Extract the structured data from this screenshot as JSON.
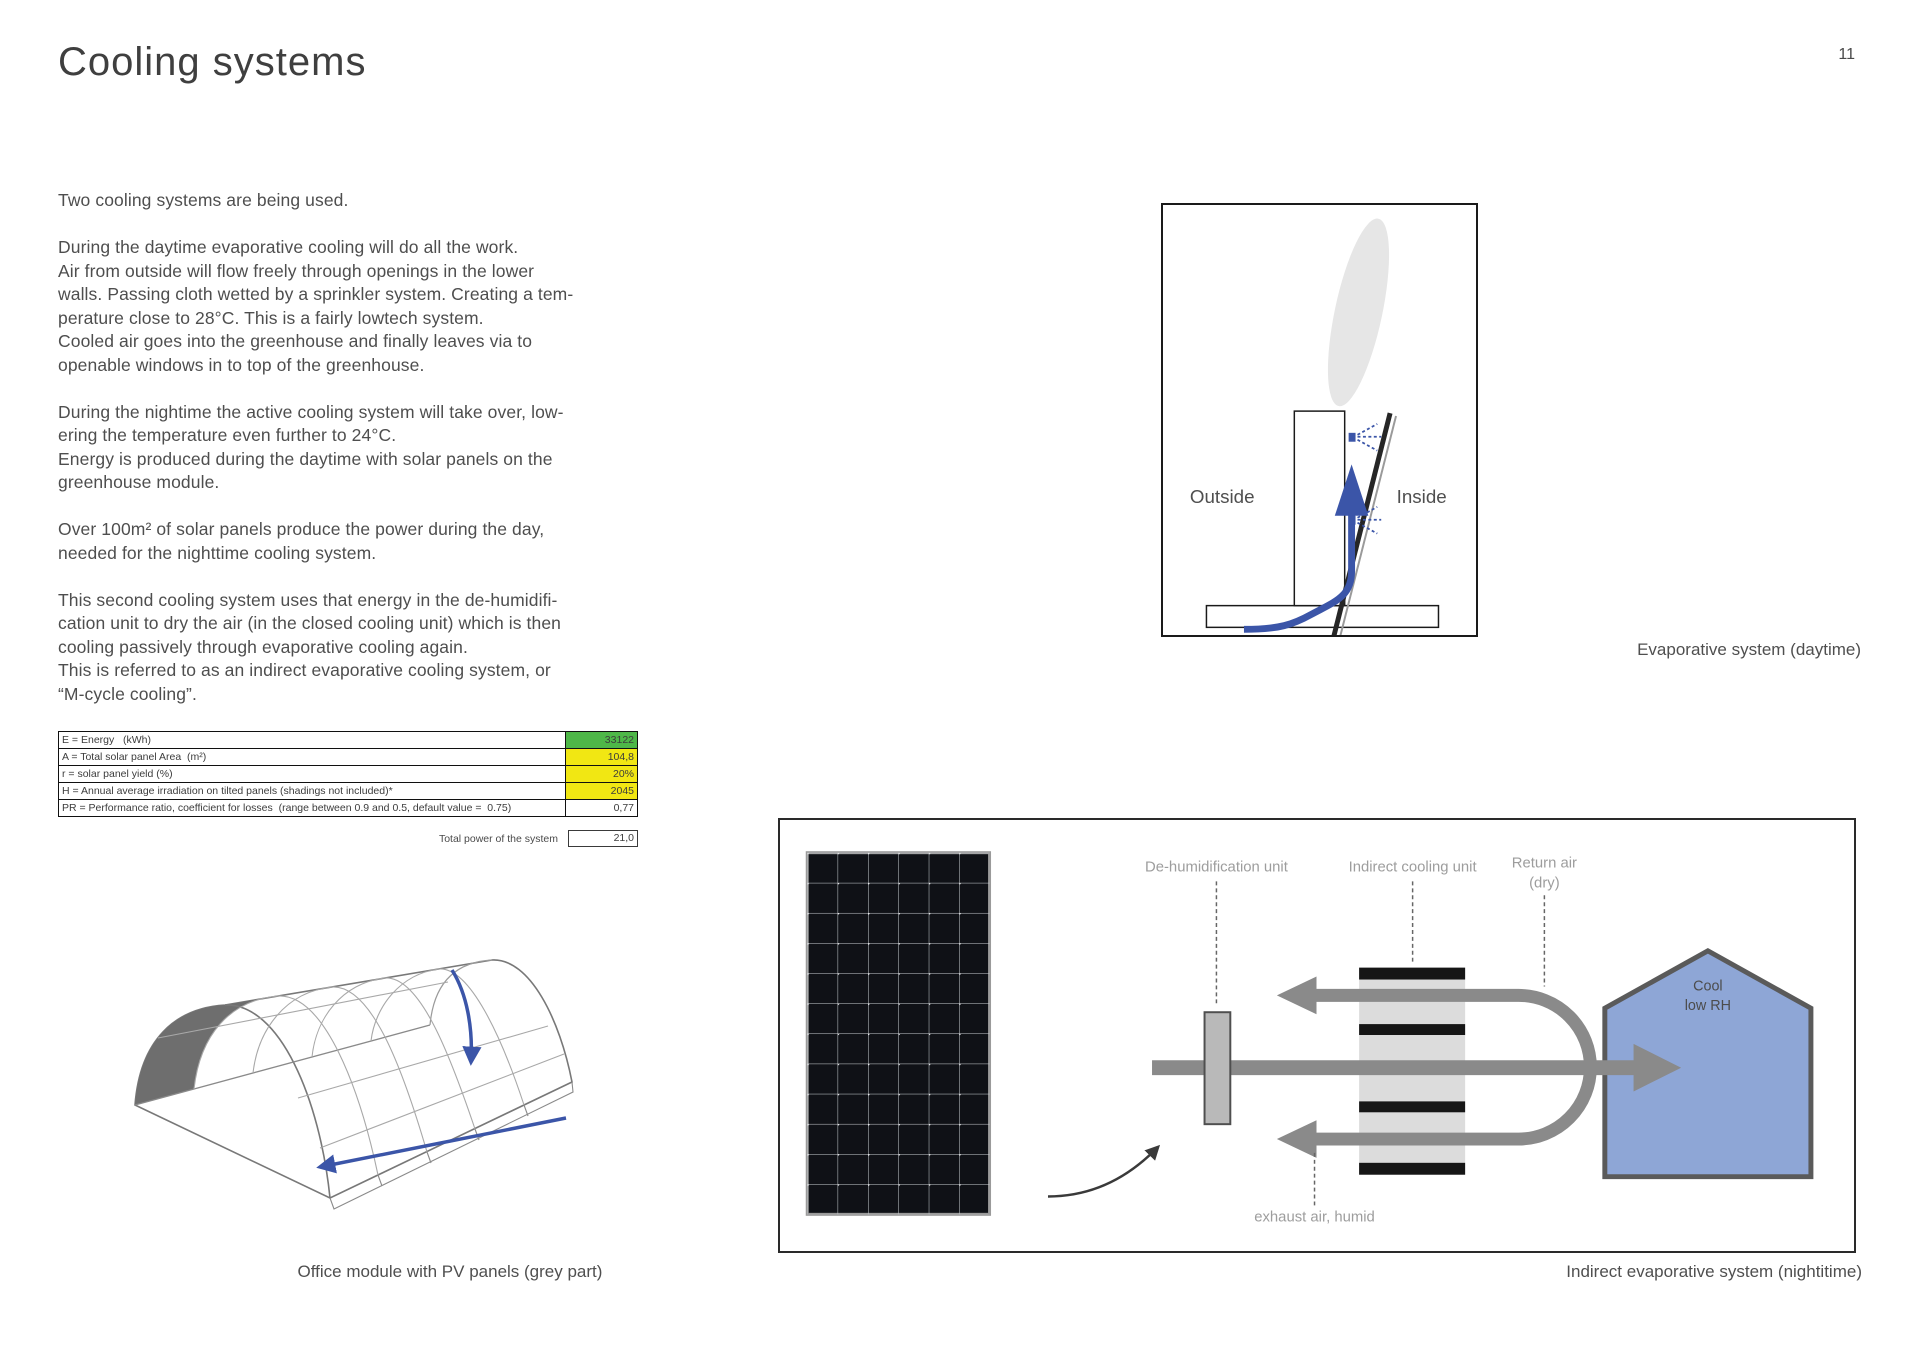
{
  "page": {
    "title": "Cooling systems",
    "number": "11"
  },
  "body": {
    "p1": "Two cooling systems are being used.",
    "p2": "During the daytime evaporative cooling will do all the work.\nAir from outside will flow freely through openings in the lower\nwalls. Passing cloth wetted by a sprinkler system. Creating a tem-\nperature close to 28°C. This is a fairly lowtech system.\nCooled air goes into the greenhouse and finally leaves via to\nopenable windows in to top of the greenhouse.",
    "p3": "During the nightime the active cooling system will take over, low-\nering the temperature even further to 24°C.\nEnergy is produced during the daytime with solar panels on the\ngreenhouse module.",
    "p4": "Over 100m² of solar panels produce the power during the day,\nneeded for the nighttime cooling system.",
    "p5": "This second cooling system uses that energy in the de-humidifi-\ncation unit to dry the air (in the closed cooling unit) which is then\ncooling passively through evaporative cooling again.\nThis is referred to as an indirect evaporative cooling system, or\n“M-cycle cooling”."
  },
  "table": {
    "rows": [
      {
        "label": "E = Energy   (kWh)",
        "value": "33122",
        "bg": "#4eb748"
      },
      {
        "label": "A = Total solar panel Area  (m²)",
        "value": "104,8",
        "bg": "#f1e713"
      },
      {
        "label": "r = solar panel yield (%)",
        "value": "20%",
        "bg": "#f1e713"
      },
      {
        "label": "H = Annual average irradiation on tilted panels (shadings not included)*",
        "value": "2045",
        "bg": "#f1e713"
      },
      {
        "label": "PR = Performance ratio, coefficient for losses  (range between 0.9 and 0.5, default value =  0.75)",
        "value": "0,77",
        "bg": "#ffffff"
      }
    ],
    "total_label": "Total power of the system",
    "total_value": "21,0"
  },
  "evaporative": {
    "outside_label": "Outside",
    "inside_label": "Inside",
    "caption": "Evaporative system (daytime)"
  },
  "office_module": {
    "caption": "Office module with PV panels (grey part)"
  },
  "indirect": {
    "labels": {
      "dehumid": "De-humidification unit",
      "cooling": "Indirect cooling unit",
      "return_line1": "Return air",
      "return_line2": "(dry)",
      "house_line1": "Cool",
      "house_line2": "low RH",
      "exhaust": "exhaust air, humid"
    },
    "caption": "Indirect evaporative system (nightitime)"
  },
  "colors": {
    "arrow_blue": "#3b55a8",
    "duct_grey": "#8a8a8a",
    "house_fill": "#8ea6d6",
    "pv_panel": "#0f1116",
    "table_green": "#4eb748",
    "table_yellow": "#f1e713",
    "pv_sketch_grey": "#6e6e6e"
  }
}
